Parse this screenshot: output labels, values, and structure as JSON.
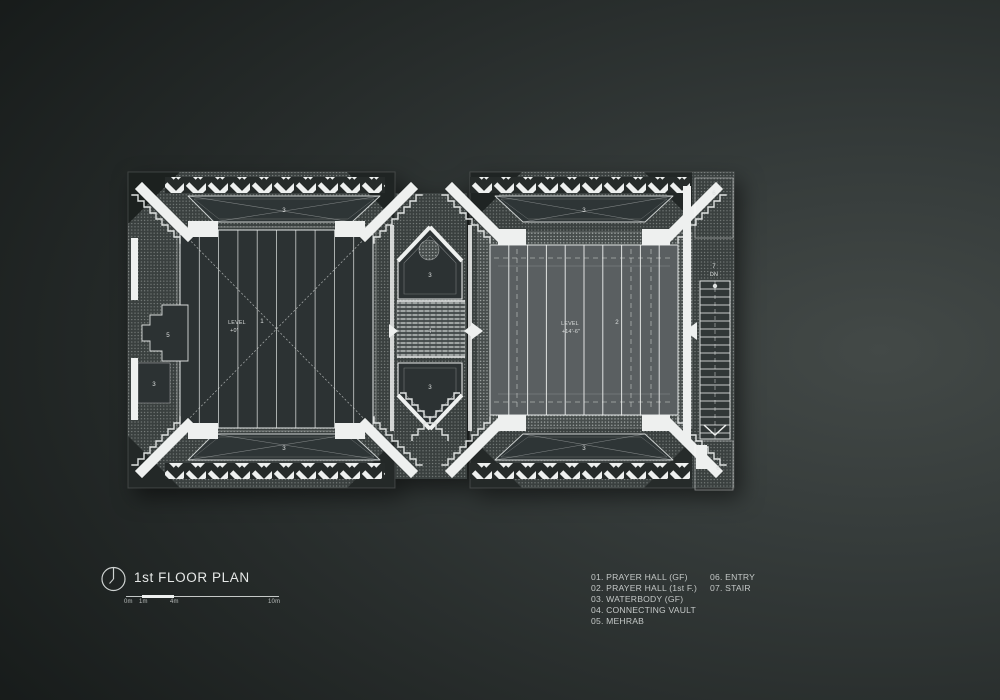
{
  "title_block": {
    "title": "1st FLOOR PLAN",
    "scale_ticks": [
      "0m",
      "1m",
      "4m",
      "10m"
    ]
  },
  "legend": {
    "column1": [
      "01. PRAYER HALL (GF)",
      "02. PRAYER HALL (1st F.)",
      "03. WATERBODY (GF)",
      "04. CONNECTING VAULT",
      "05. MEHRAB"
    ],
    "column2": [
      "06. ENTRY",
      "07. STAIR"
    ]
  },
  "plan": {
    "hall1": {
      "number": "1",
      "level_label": "LEVEL",
      "level_value": "+0'"
    },
    "hall2": {
      "number": "2",
      "level_label": "LEVEL",
      "level_value": "+14'-6\""
    },
    "waterbody_number": "3",
    "vault_number": "4",
    "mehrab_number": "5",
    "entry_number": "6",
    "stair_number": "7",
    "stair_direction": "DN"
  },
  "colors": {
    "background_dark": "#141817",
    "background_light": "#434947",
    "plan_white": "#eef0ef",
    "hall_dark_fill": "#2c3233",
    "hall_light_fill": "#5a5f61",
    "texture_base": "#3a403f"
  }
}
